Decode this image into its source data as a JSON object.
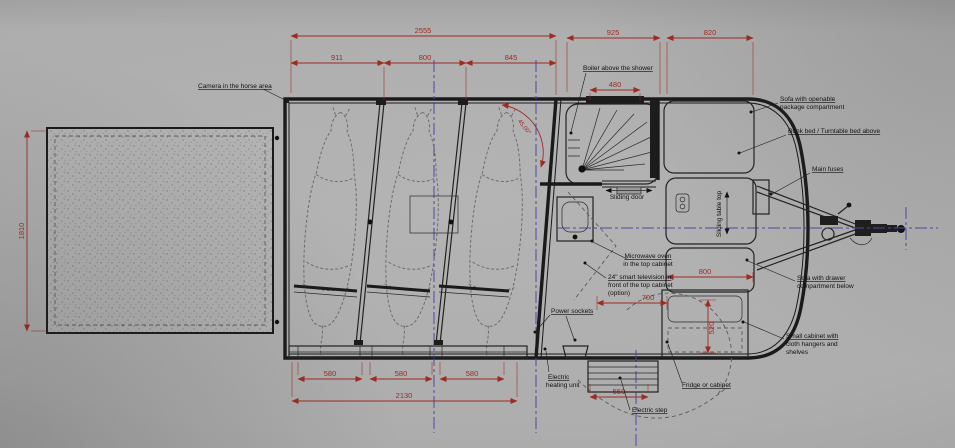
{
  "drawing": {
    "type": "horse-trailer-floor-plan",
    "labels": {
      "camera": "Camera in the horse area",
      "boiler": "Boiler above the shower",
      "sofa_top_1": "Sofa with openable",
      "sofa_top_2": "package compartment",
      "bunk": "Bunk bed / Turntable bed above",
      "main_fuses": "Main fuses",
      "sliding_door": "Sliding door",
      "sliding_table": "Sliding table top",
      "microwave_1": "Microwave oven",
      "microwave_2": "in the top cabinet",
      "tv_1": "24\" smart television in",
      "tv_2": "front of the top cabinet",
      "tv_3": "(option)",
      "sofa_drawer_1": "Sofa with drawer",
      "sofa_drawer_2": "compartment below",
      "small_cabinet_1": "Small cabinet with",
      "small_cabinet_2": "cloth hangers and",
      "small_cabinet_3": "shelves",
      "sockets": "Power sockets",
      "heating_1": "Electric",
      "heating_2": "heating unit",
      "fridge": "Fridge or cabinet",
      "step": "Electric step"
    },
    "dims": {
      "top_total": "2555",
      "stall_1": "911",
      "stall_2": "800",
      "stall_3": "845",
      "bathroom_width": "925",
      "front_width": "820",
      "boiler_width": "480",
      "ramp_length": "1810",
      "sofa_width": "800",
      "aisle_width": "700",
      "cabinet_depth": "520",
      "floor_1": "580",
      "floor_2": "580",
      "floor_3": "580",
      "floor_total": "2130",
      "step_width": "550",
      "wall_angle": "45.00°"
    },
    "colors": {
      "dimension_red": "#9e2b22",
      "centerline_blue": "#4a4aa8",
      "ink": "#1a1a1a",
      "paper": "#adadad"
    }
  }
}
